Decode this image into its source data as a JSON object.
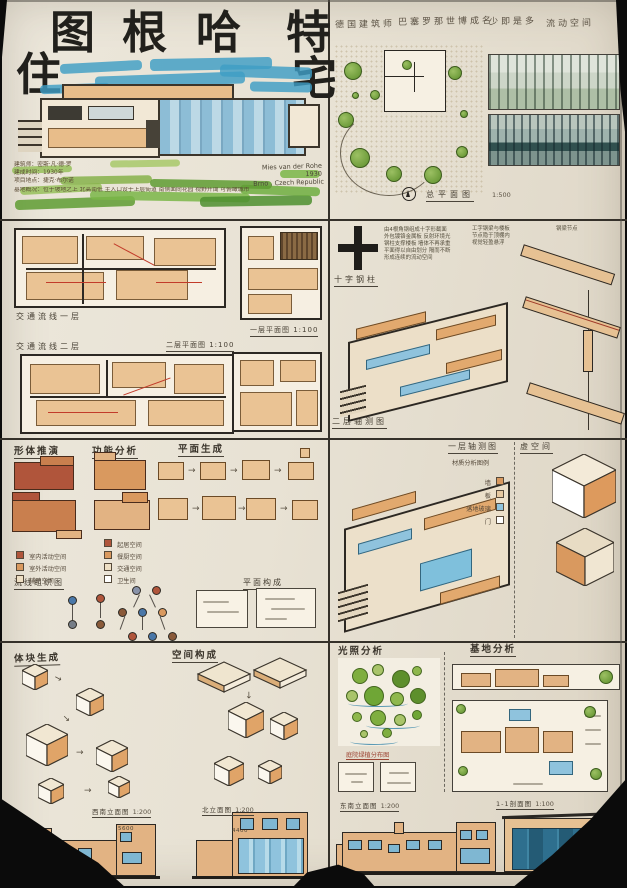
{
  "palette": {
    "paper": "#e9e3d6",
    "ink": "#2c2823",
    "tan": "#e2b383",
    "orange": "#d9995f",
    "red": "#b0553b",
    "glass": "#8fc3dd",
    "teal": "#2e6f8e",
    "green": "#6fae3f",
    "sky": "#3e9dc5"
  },
  "title": {
    "main": [
      "图",
      "根",
      "哈",
      "特"
    ],
    "sub": [
      "住",
      "宅"
    ]
  },
  "intro": {
    "notes": [
      "建筑师：密斯·凡·德·罗",
      "建成时间：1930年",
      "项目地点：捷克·布尔诺",
      "基地概况：位于坡地之上 北高南低 主入口设于上层街道 南侧面向花园 视野开阔 可俯瞰城市"
    ],
    "credit": [
      "Mies van der Rohe",
      "1930",
      "Brno . Czech Republic"
    ]
  },
  "overview": {
    "keywords": [
      "德国建筑师",
      "巴塞罗那世博成名",
      "少即是多",
      "流动空间"
    ],
    "siteplan_label": "总平面图",
    "siteplan_scale": "1:500"
  },
  "plans": {
    "circ1": "交通流线一层",
    "circ2": "交通流线二层",
    "plan1": "一层平面图 1:100",
    "plan2": "二层平面图 1:100"
  },
  "structure": {
    "column_label": "十字钢柱",
    "axon_label": "二层轴测图",
    "beam_note": "钢梁节点",
    "notes_a": [
      "由4根角钢组成十字形截面",
      "外包镀铬金属板 反射环境光",
      "钢柱支撑楼板 墙体不再承重",
      "平面得以自由划分 隔而不断",
      "形成连续的流动空间"
    ],
    "notes_b": [
      "工字钢梁与楼板",
      "节点隐于顶棚内",
      "视觉轻盈悬浮"
    ]
  },
  "analysis": {
    "headers": [
      "形体推演",
      "功能分析",
      "平面生成"
    ],
    "legend_a": [
      {
        "label": "室内活动空间",
        "color": "#b0553b"
      },
      {
        "label": "室外活动空间",
        "color": "#d9995f"
      },
      {
        "label": "辅助空间",
        "color": "#eedfc4"
      }
    ],
    "legend_b": [
      {
        "label": "起居空间",
        "color": "#b0553b"
      },
      {
        "label": "餐厨空间",
        "color": "#d9995f"
      },
      {
        "label": "交通空间",
        "color": "#eedfc4"
      },
      {
        "label": "卫生间",
        "color": "#ffffff"
      }
    ],
    "flow_label": "流线组织图",
    "compose_label": "平面构成"
  },
  "axon1": {
    "label": "一层轴测图",
    "void_label": "虚空间",
    "legend_title": "材质分析图例",
    "legend": [
      {
        "label": "墙",
        "color": "#d9995f"
      },
      {
        "label": "板",
        "color": "#e7c9a1"
      },
      {
        "label": "落地玻璃",
        "color": "#8fc3dd"
      },
      {
        "label": "门",
        "color": "#ffffff"
      }
    ]
  },
  "massing": {
    "left_header": "体块生成",
    "right_header": "空间构成"
  },
  "site": {
    "light_header": "光照分析",
    "base_header": "基地分析",
    "pond_label": "庭院绿植分布图"
  },
  "drawings": {
    "elev_a": {
      "label": "西南立面图",
      "scale": "1:200",
      "dim": "5600"
    },
    "elev_b": {
      "label": "北立面图",
      "scale": "1:200",
      "dim": "4400"
    },
    "elev_c": {
      "label": "东南立面图",
      "scale": "1:200"
    },
    "section": {
      "label": "1-1剖面图",
      "scale": "1:100"
    }
  }
}
